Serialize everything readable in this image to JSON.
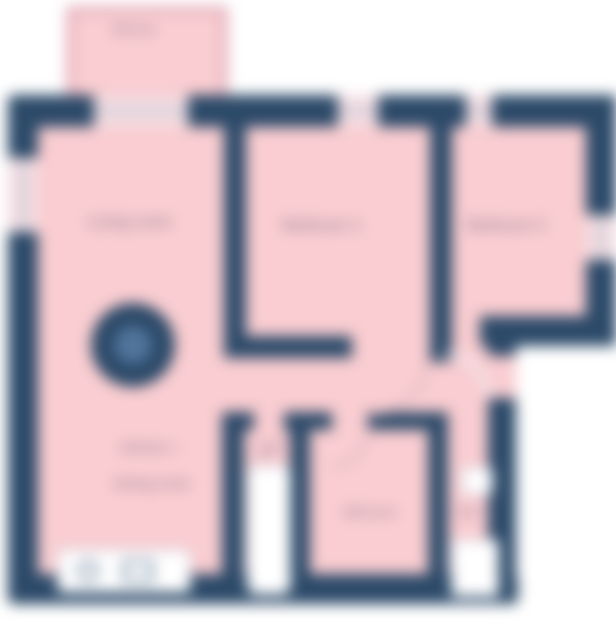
{
  "diagram": {
    "kind": "apartment-floor-plan",
    "style": "blurred screenshot of a 2D floor plan, dark navy walls on white background with pink room fill"
  },
  "rooms": {
    "balcony": {
      "label": "Balcony"
    },
    "living": {
      "label": "Living room"
    },
    "bedroom1": {
      "label": "Bedroom 1"
    },
    "bedroom2": {
      "label": "Bedroom 2"
    },
    "kitchen": {
      "line1": "Kitchen +",
      "line2": "Dining room"
    },
    "wc": {
      "label": "WC"
    },
    "bathroom": {
      "label": "Bathroom"
    },
    "hall": {
      "label": "Hall"
    }
  },
  "icons": {
    "dining_table": "dining-table-icon",
    "kitchen_counter": "kitchen-counter-icon",
    "bathtub": "bathtub-icon",
    "hall_cabinet": "cabinet-icon"
  },
  "colors": {
    "wall": "#2c4a69",
    "room_fill": "#f9cdd1",
    "outside": "#ffffff",
    "window_line": "#a9b9c9",
    "label_text": "#857286",
    "table_inner": "#50749b",
    "balcony_wall": "#e3aebb"
  }
}
